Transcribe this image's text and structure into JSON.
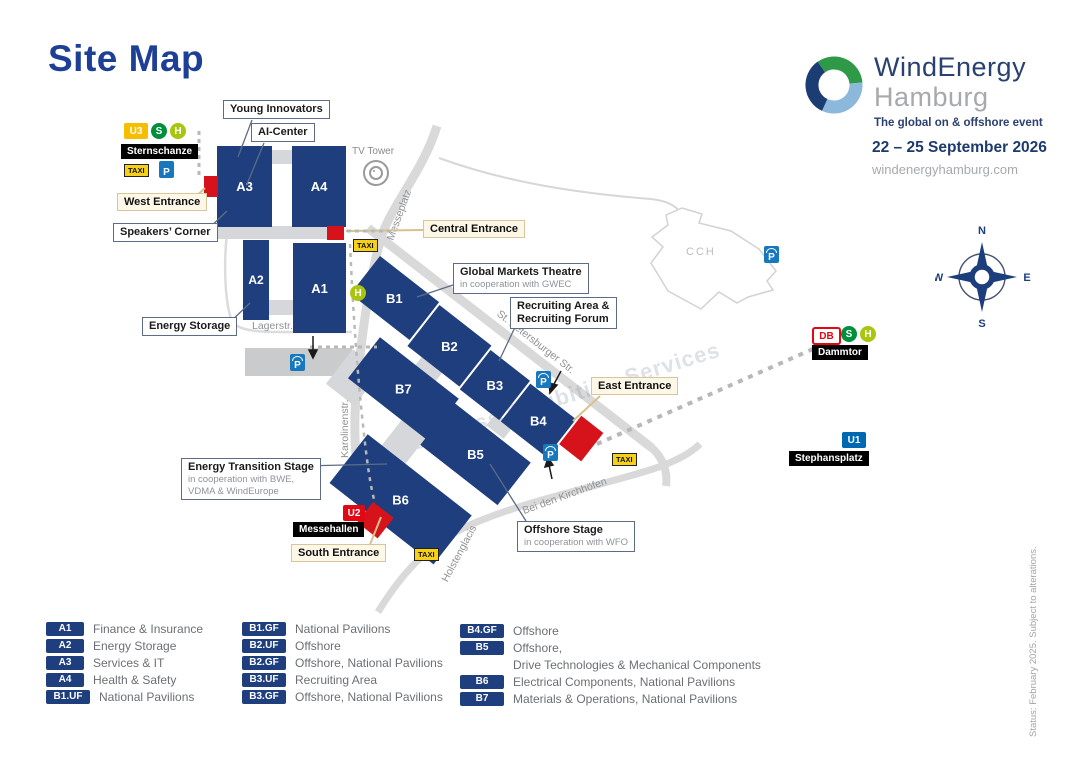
{
  "page": {
    "title": "Site Map"
  },
  "brand": {
    "name_line1": "WindEnergy",
    "name_line2": "Hamburg",
    "tagline": "The global on & offshore event",
    "dates": "22 – 25 September 2026",
    "website": "windenergyhamburg.com"
  },
  "halls": {
    "a1": "A1",
    "a2": "A2",
    "a3": "A3",
    "a4": "A4",
    "b1": "B1",
    "b2": "B2",
    "b3": "B3",
    "b4": "B4",
    "b5": "B5",
    "b6": "B6",
    "b7": "B7"
  },
  "entrances": {
    "west": "West Entrance",
    "central": "Central Entrance",
    "east": "East Entrance",
    "south": "South Entrance"
  },
  "features": {
    "young_innovators": "Young Innovators",
    "ai_center": "AI-Center",
    "speakers_corner": "Speakers’ Corner",
    "energy_storage": "Energy Storage",
    "global_markets": {
      "title": "Global Markets Theatre",
      "subtitle": "in cooperation with GWEC"
    },
    "recruiting": {
      "line1": "Recruiting Area &",
      "line2": "Recruiting Forum"
    },
    "energy_transition": {
      "title": "Energy Transition Stage",
      "sub1": "in cooperation with BWE,",
      "sub2": "VDMA & WindEurope"
    },
    "offshore_stage": {
      "title": "Offshore Stage",
      "subtitle": "in cooperation with WFO"
    }
  },
  "stations": {
    "sternschanze": {
      "name": "Sternschanze",
      "lines": [
        "U3",
        "S",
        "H"
      ]
    },
    "dammtor": {
      "name": "Dammtor",
      "lines": [
        "DB",
        "S",
        "H"
      ]
    },
    "stephansplatz": {
      "name": "Stephansplatz",
      "line": "U1"
    },
    "messehallen": {
      "name": "Messehallen",
      "line": "U2"
    }
  },
  "transport_icons": {
    "taxi": "TAXI",
    "parking": "P"
  },
  "streets": {
    "messeplatz": "Messeplatz",
    "lagerstr": "Lagerstr.",
    "karolinenstr": "Karolinenstr.",
    "st_petersburger": "St. Petersburger Str.",
    "bei_den_kirchhofen": "Bei den Kirchhöfen",
    "holstenglacis": "Holstenglacis"
  },
  "landmarks": {
    "tv_tower": "TV Tower",
    "cch": "CCH"
  },
  "compass": {
    "n": "N",
    "e": "E",
    "s": "S",
    "w": "W"
  },
  "watermark": "Congress Exhibition Services",
  "status_note": "Status: February 2025. Subject to alterations.",
  "colors": {
    "hall_blue": "#1e3e7d",
    "entrance_red": "#d6121b",
    "accent_navy": "#1e3f96",
    "taxi_yellow": "#f7d117",
    "parking_blue": "#1878be",
    "u1_blue": "#0067b1",
    "u2_red": "#e30613",
    "u3_yellow": "#f6be00",
    "sbahn_green": "#008f3c",
    "bus_green": "#a9c50f",
    "db_red": "#e30613"
  },
  "legend": {
    "col1": [
      {
        "code": "A1",
        "label": "Finance & Insurance"
      },
      {
        "code": "A2",
        "label": "Energy Storage"
      },
      {
        "code": "A3",
        "label": "Services & IT"
      },
      {
        "code": "A4",
        "label": "Health & Safety"
      },
      {
        "code": "B1.UF",
        "label": "National Pavilions"
      }
    ],
    "col2": [
      {
        "code": "B1.GF",
        "label": "National Pavilions"
      },
      {
        "code": "B2.UF",
        "label": "Offshore"
      },
      {
        "code": "B2.GF",
        "label": "Offshore, National Pavilions"
      },
      {
        "code": "B3.UF",
        "label": "Recruiting Area"
      },
      {
        "code": "B3.GF",
        "label": "Offshore, National Pavilions"
      }
    ],
    "col3": [
      {
        "code": "B4.GF",
        "label": "Offshore"
      },
      {
        "code": "B5",
        "label": "Offshore,",
        "label2": "Drive Technologies & Mechanical Components"
      },
      {
        "code": "B6",
        "label": "Electrical Components, National Pavilions"
      },
      {
        "code": "B7",
        "label": "Materials & Operations, National Pavilions"
      }
    ]
  }
}
